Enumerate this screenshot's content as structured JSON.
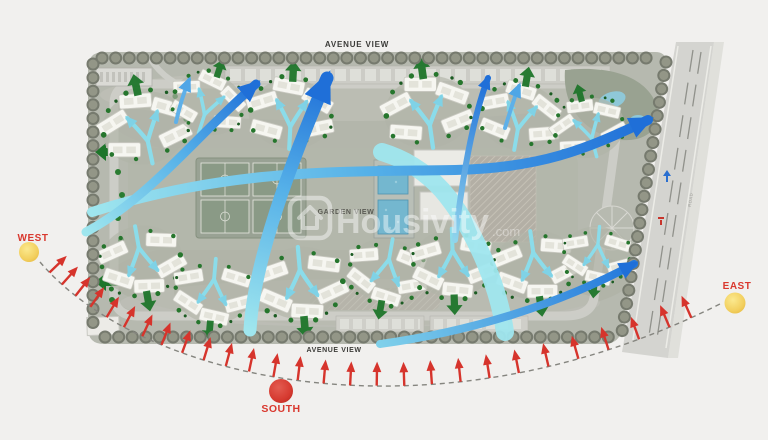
{
  "plan": {
    "labels": {
      "avenue_view_top": "AVENUE VIEW",
      "avenue_view_bottom": "AVENUE VIEW",
      "garden_view": "GARDEN VIEW",
      "road": "ROAD"
    },
    "compass": {
      "west": "WEST",
      "south": "SOUTH",
      "east": "EAST"
    },
    "watermark": {
      "brand": "Housivity",
      "suffix": ".com",
      "icon": "house-logo-icon"
    },
    "colors": {
      "background": "#f1f0ee",
      "site_base": "#b6b9af",
      "sun": "#f2cf5e",
      "south_marker": "#d63a30",
      "sun_path_arrow": "#d6342c",
      "wind_flow_start": "#9fe6ee",
      "wind_flow_end": "#1f6fd8",
      "greenery": "#26762d",
      "road_surface": "#d4d4d0"
    }
  }
}
